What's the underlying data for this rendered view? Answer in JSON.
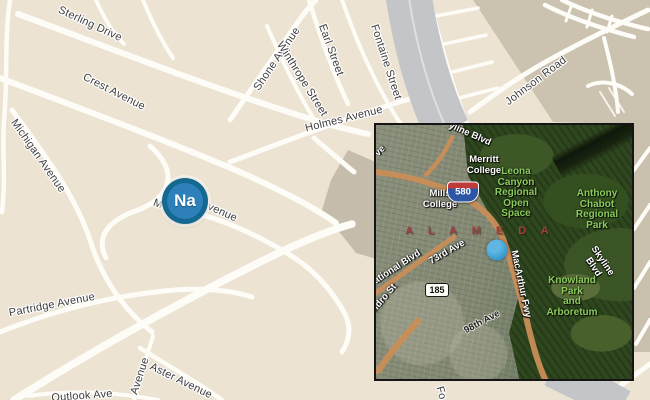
{
  "main_map": {
    "marker_label": "Na",
    "streets": {
      "sterling": "Sterling Drive",
      "crest": "Crest Avenue",
      "michigan": "Michigan Avenue",
      "shone": "Shone Avenue",
      "winthrope": "Winthrope Street",
      "earl": "Earl Street",
      "fontaine": "Fontaine Street",
      "holmes": "Holmes Avenue",
      "johnson": "Johnson Road",
      "partridge": "Partridge Avenue",
      "aster": "Aster Avenue",
      "avenue_fragment": "Avenue",
      "outlook": "Outlook Ave",
      "marker_street_left_fragment": "M",
      "marker_street_right_fragment": "Avenue",
      "fontaine_bottom_fragment": "Fo"
    }
  },
  "inset": {
    "labels": {
      "ave_fragment": "ve",
      "skyline_top_fragment": "yline Blvd",
      "merritt_college": "Merritt\nCollege",
      "leona_canyon": "Leona\nCanyon\nRegional\nOpen\nSpace",
      "anthony_chabot": "Anthony\nChabot\nRegional\nPark",
      "mills_college": "Mills\nCollege",
      "alameda": "A L A M E D A",
      "seventy_third_ave": "73rd Ave",
      "international_blvd_fragment": "ational Blvd",
      "macarthur_fwy": "MacArthur Fwy",
      "skyline_blvd": "Skyline Blvd",
      "knowland_park": "Knowland\nPark\nand\nArboretum",
      "san_leandro_fragment": "ndro St",
      "ninety_eighth_ave": "98th Ave",
      "i580": "580",
      "ca185": "185"
    }
  },
  "colors": {
    "land": "#ece3d2",
    "land_dark": "#cbc2b0",
    "road": "#fdfcf7",
    "freeway_gray": "#c3c5c8",
    "marker_ring": "#15688f",
    "marker_fill": "#2d80b9",
    "inset_dot_blue": "#3396cc",
    "park_label_green": "#8bcb5c",
    "alameda_maroon": "#9c4040"
  }
}
